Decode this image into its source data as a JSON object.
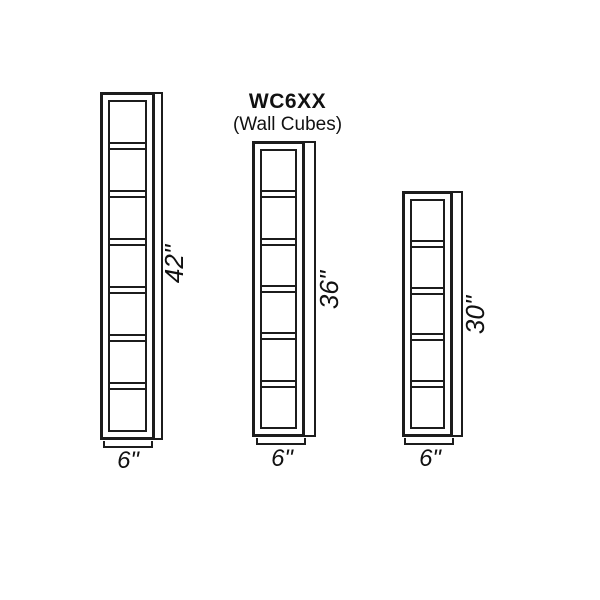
{
  "title": {
    "model": "WC6XX",
    "subtitle": "(Wall Cubes)"
  },
  "cabinets": [
    {
      "compartments": 7,
      "height_label": "42\"",
      "width_label": "6\""
    },
    {
      "compartments": 6,
      "height_label": "36\"",
      "width_label": "6\""
    },
    {
      "compartments": 5,
      "height_label": "30\"",
      "width_label": "6\""
    }
  ],
  "colors": {
    "line": "#1c1c1c",
    "background": "#ffffff",
    "text": "#111111"
  }
}
